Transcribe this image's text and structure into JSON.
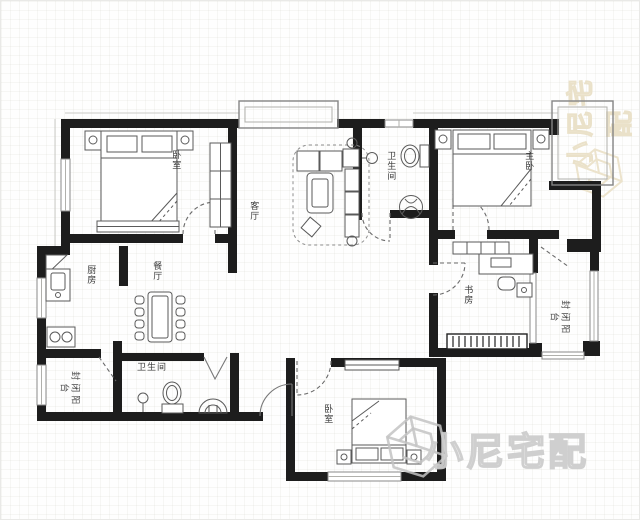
{
  "floorplan": {
    "rooms": {
      "bedroom1": {
        "label": "卧室"
      },
      "living": {
        "label": "客厅"
      },
      "bath1": {
        "label": "卫生间"
      },
      "master": {
        "label": "主卧"
      },
      "study": {
        "label": "书房"
      },
      "balcony_east": {
        "label": "封闭阳台"
      },
      "dining": {
        "label": "餐厅"
      },
      "kitchen": {
        "label": "厨房"
      },
      "balcony_west": {
        "label": "封闭阳台"
      },
      "bath2": {
        "label": "卫生间"
      },
      "bedroom2": {
        "label": "卧室"
      }
    },
    "colors": {
      "wall": "#1d1d1d",
      "furniture_line": "#5a5a5a",
      "window_frame": "#8a8a8a",
      "label": "#3a3a3a"
    }
  },
  "watermark": {
    "brand": "小尼宅配",
    "side_color": "#eae1c9",
    "bottom_color": "#cacaca"
  }
}
